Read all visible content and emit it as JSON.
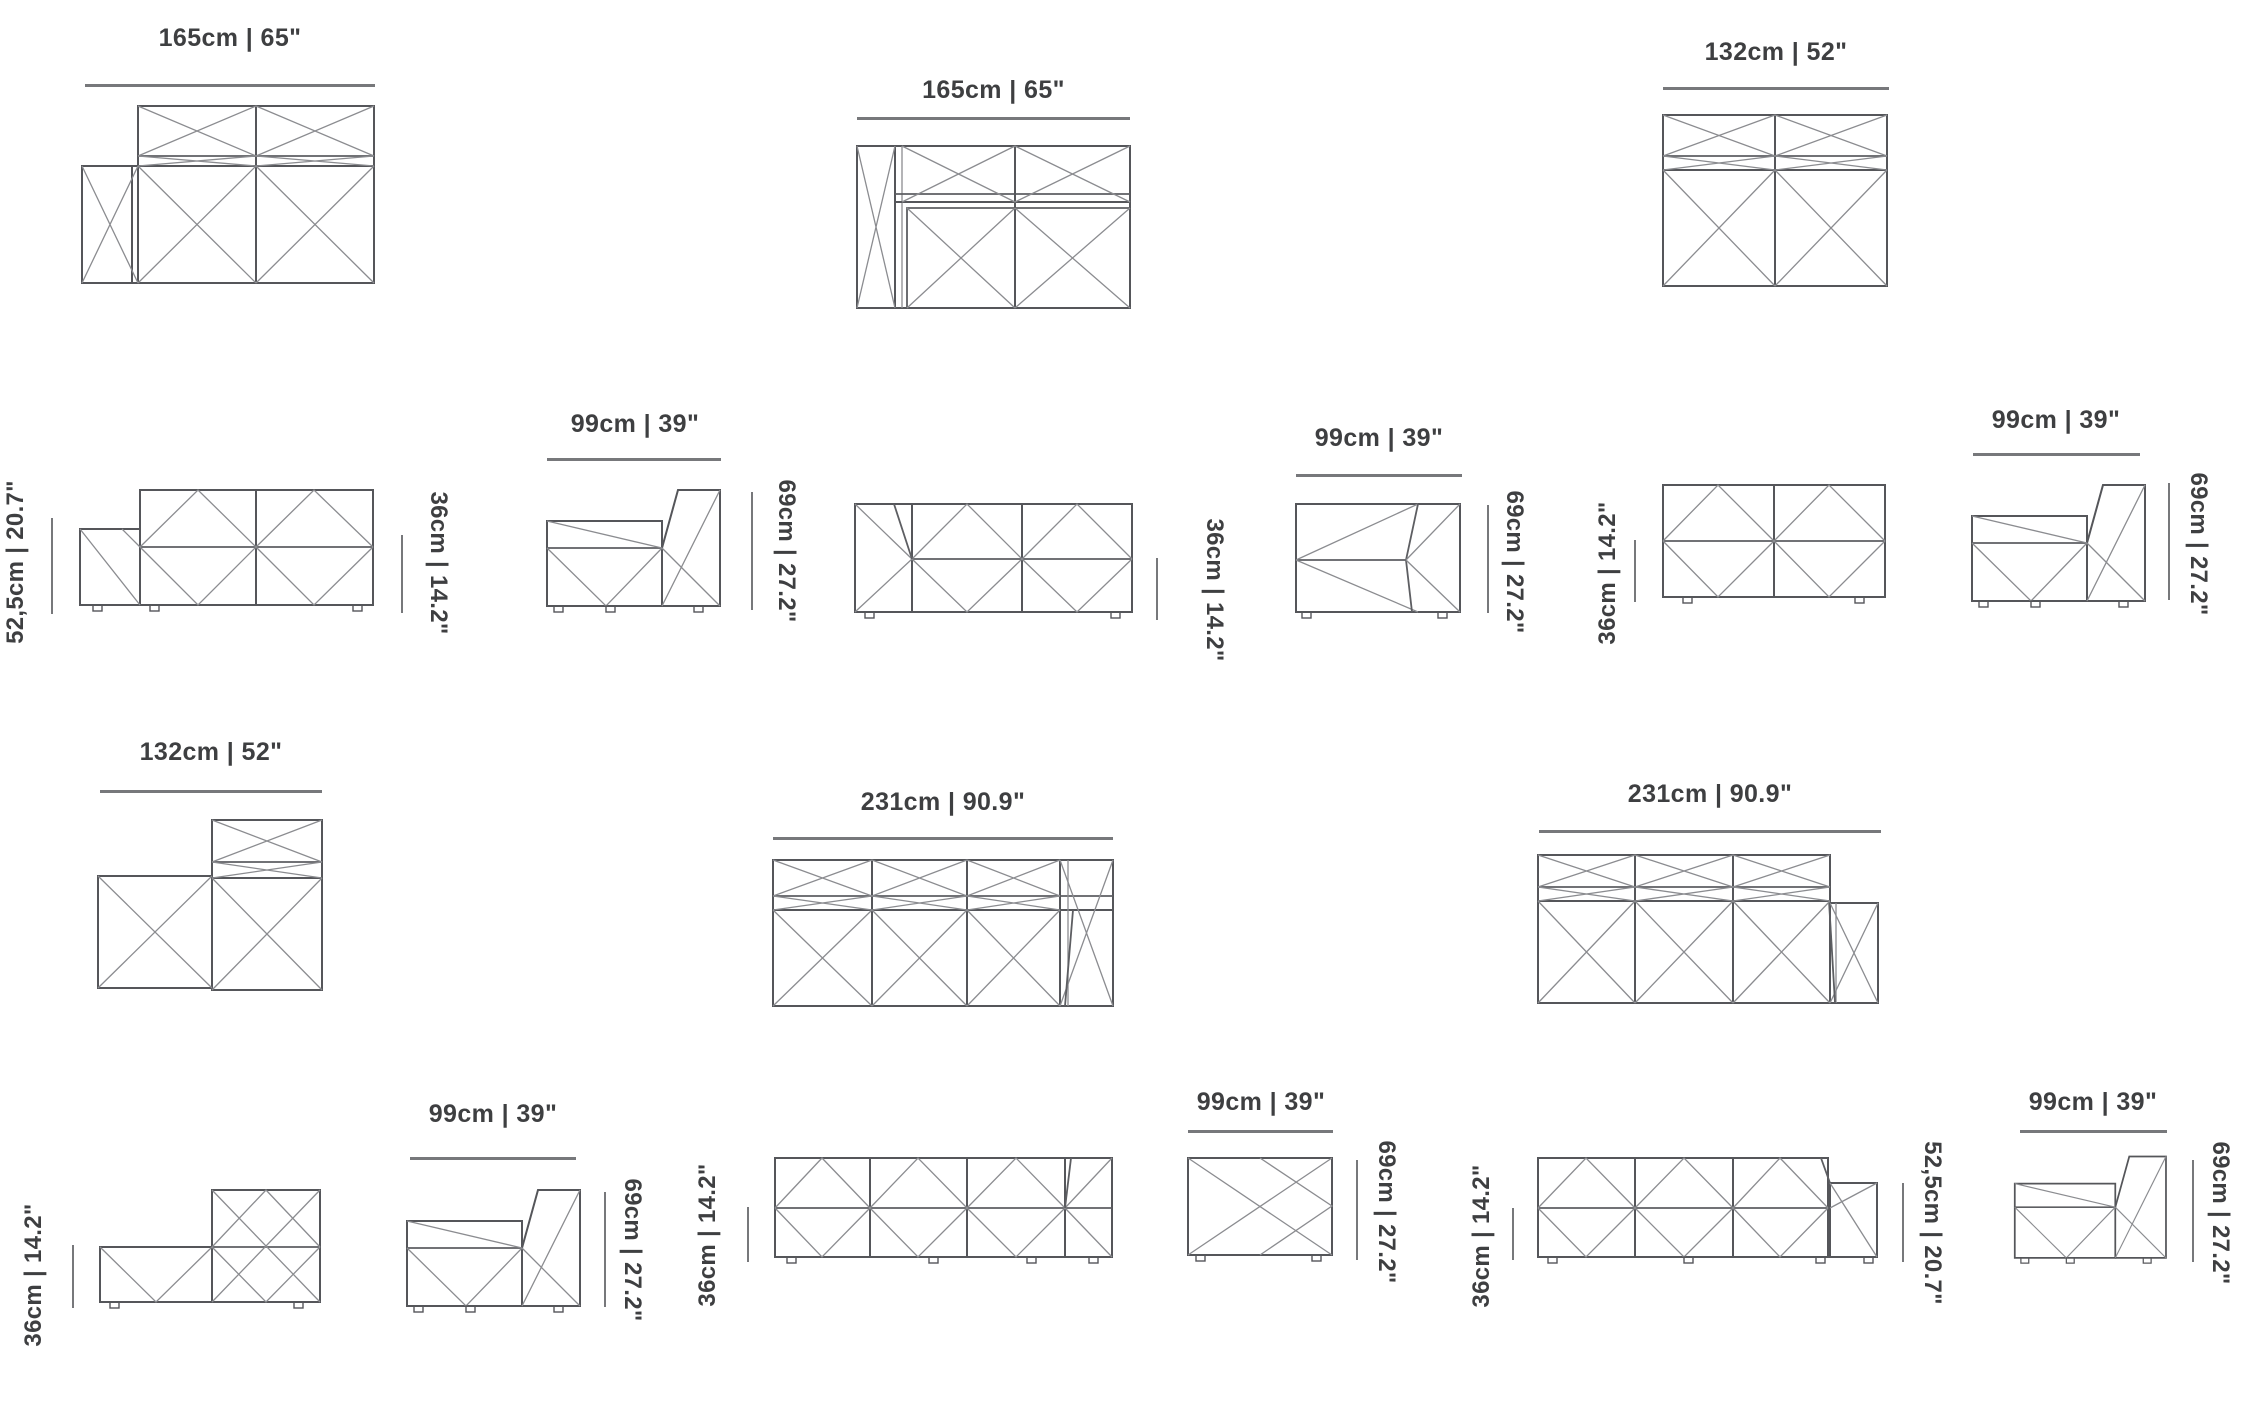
{
  "colors": {
    "line": "#55565a",
    "line_light": "#8b8c90",
    "text": "#3e3f41",
    "dim_line": "#77787b"
  },
  "products": [
    {
      "top_view": {
        "width": "165cm | 65\""
      },
      "front_view": {
        "height_left": "52,5cm | 20.7\"",
        "height_right": "36cm | 14.2\""
      },
      "side_view": {
        "width": "99cm | 39\"",
        "height": "69cm | 27.2\""
      }
    },
    {
      "top_view": {
        "width": "165cm | 65\""
      },
      "front_view": {
        "height_right": "36cm | 14.2\""
      },
      "side_view": {
        "width": "99cm | 39\"",
        "height": "69cm | 27.2\""
      }
    },
    {
      "top_view": {
        "width": "132cm | 52\""
      },
      "front_view": {
        "height_left": "36cm | 14.2\""
      },
      "side_view": {
        "width": "99cm | 39\"",
        "height": "69cm | 27.2\""
      }
    },
    {
      "top_view": {
        "width": "132cm | 52\""
      },
      "front_view": {
        "height_left": "36cm | 14.2\""
      },
      "side_view": {
        "width": "99cm | 39\"",
        "height": "69cm | 27.2\""
      }
    },
    {
      "top_view": {
        "width": "231cm | 90.9\""
      },
      "front_view": {
        "height_left": "36cm | 14.2\""
      },
      "side_view": {
        "width": "99cm | 39\"",
        "height": "69cm | 27.2\""
      }
    },
    {
      "top_view": {
        "width": "231cm | 90.9\""
      },
      "front_view": {
        "height_left": "36cm | 14.2\"",
        "height_right": "52,5cm | 20.7\""
      },
      "side_view": {
        "width": "99cm | 39\"",
        "height": "69cm | 27.2\""
      }
    }
  ]
}
